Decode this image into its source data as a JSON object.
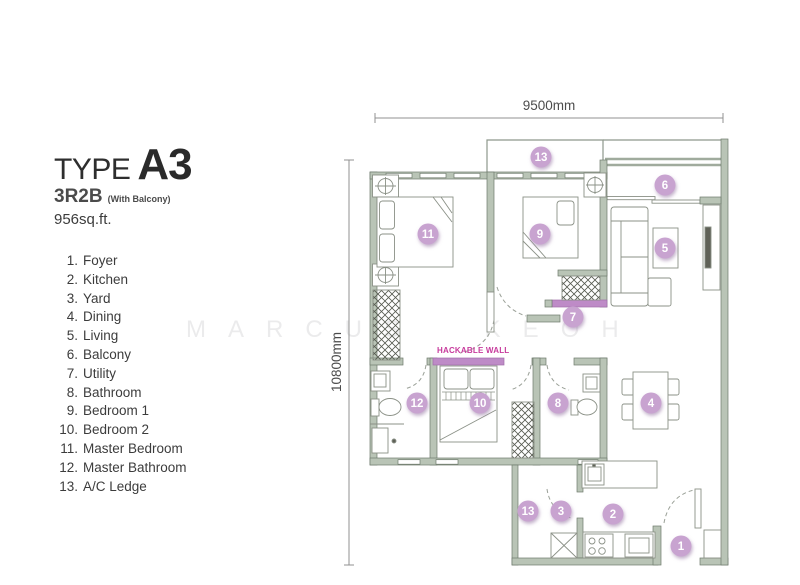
{
  "header": {
    "type_label": "TYPE",
    "model": "A3",
    "layout": "3R2B",
    "layout_note": "(With Balcony)",
    "area": "956sq.ft."
  },
  "legend": {
    "items": [
      {
        "num": "1.",
        "label": "Foyer"
      },
      {
        "num": "2.",
        "label": "Kitchen"
      },
      {
        "num": "3.",
        "label": "Yard"
      },
      {
        "num": "4.",
        "label": "Dining"
      },
      {
        "num": "5.",
        "label": "Living"
      },
      {
        "num": "6.",
        "label": "Balcony"
      },
      {
        "num": "7.",
        "label": "Utility"
      },
      {
        "num": "8.",
        "label": "Bathroom"
      },
      {
        "num": "9.",
        "label": "Bedroom 1"
      },
      {
        "num": "10.",
        "label": "Bedroom 2"
      },
      {
        "num": "11.",
        "label": "Master Bedroom"
      },
      {
        "num": "12.",
        "label": "Master Bathroom"
      },
      {
        "num": "13.",
        "label": "A/C Ledge"
      }
    ]
  },
  "watermark": "MARCUS KEOH",
  "plan": {
    "dim_width": "9500mm",
    "dim_height": "10800mm",
    "hackable_wall_label": "HACKABLE WALL",
    "markers": [
      {
        "n": "1",
        "x": 681,
        "y": 546
      },
      {
        "n": "2",
        "x": 613,
        "y": 514
      },
      {
        "n": "3",
        "x": 561,
        "y": 511
      },
      {
        "n": "4",
        "x": 651,
        "y": 403
      },
      {
        "n": "5",
        "x": 665,
        "y": 248
      },
      {
        "n": "6",
        "x": 665,
        "y": 185
      },
      {
        "n": "7",
        "x": 573,
        "y": 317
      },
      {
        "n": "8",
        "x": 558,
        "y": 403
      },
      {
        "n": "9",
        "x": 540,
        "y": 234
      },
      {
        "n": "10",
        "x": 480,
        "y": 403
      },
      {
        "n": "11",
        "x": 428,
        "y": 234
      },
      {
        "n": "12",
        "x": 417,
        "y": 403
      },
      {
        "n": "13",
        "x": 541,
        "y": 157
      },
      {
        "n": "13",
        "x": 528,
        "y": 511
      }
    ]
  },
  "colors": {
    "wall": "#b9c4b6",
    "wall_outline": "#6e7b6c",
    "thin_line": "#8e988c",
    "furniture_line": "#8b9187",
    "marker_fill": "#c8a3d0",
    "marker_text": "#ffffff",
    "marker_shadow": "#a285ad",
    "hackable_wall_fill": "#be8bc7",
    "hackable_wall_text": "#c73a9c",
    "dimension_text": "#4c4c4c"
  }
}
